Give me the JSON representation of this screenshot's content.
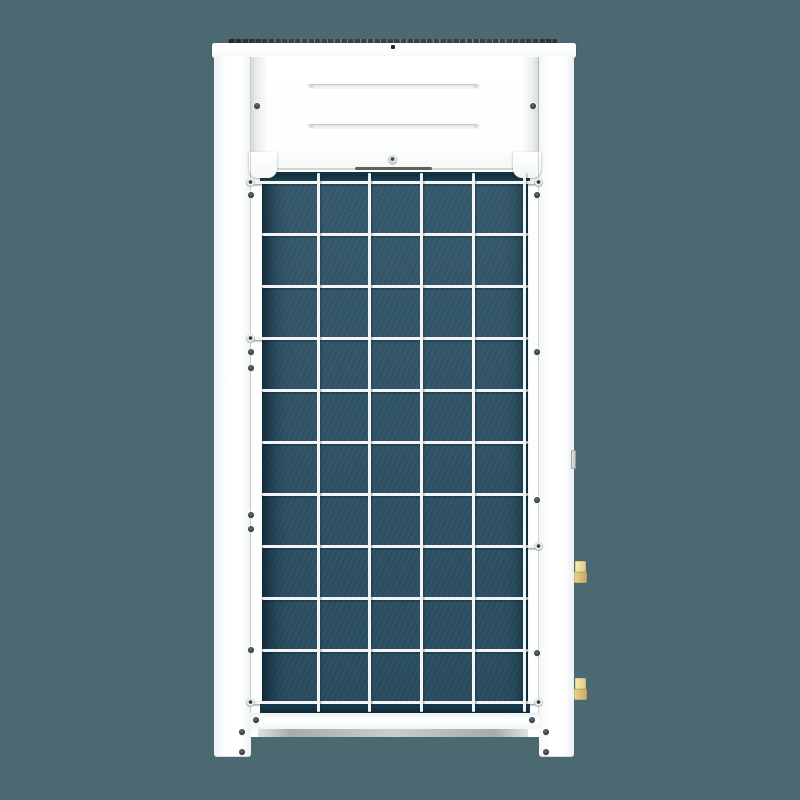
{
  "scene": {
    "subject": "white monoblock heat pump outdoor unit, rear elevation with coil guard grid",
    "background_style": "solid studio backdrop, no text or labels visible"
  },
  "colors": {
    "bg": "#4C6871",
    "cabinet": "#FFFFFF",
    "coil": "#2B5164",
    "coilEdge": "#143A4C",
    "wire": "#F3F5F5",
    "grille": "#3A4143",
    "plinth": "#AEB4B4",
    "brassLight": "#EFE19C",
    "brassDark": "#D8C17C",
    "screw": "#2E3537",
    "serviceTab": "#C7CBCD"
  },
  "parts": {
    "top_grille": "top fan grille (edge-on)",
    "top_cap": "white top cap panel",
    "left_side": "left side panel and leg",
    "right_side": "right side panel and leg",
    "front_panel": "upper access panel with two vent slots",
    "coil": "evaporator coil behind wire guard",
    "wire_grid": "white wire guard grid",
    "base_rail": "bottom rail",
    "plinth": "recessed gray base plinth",
    "fittings": "brass refrigerant pipe connections",
    "service_tab": "gray hinge bracket on right edge"
  },
  "vent_slots": [
    {
      "cx": 393,
      "cy": 86
    },
    {
      "cx": 393,
      "cy": 126
    }
  ],
  "grid": {
    "h_wires": [
      {
        "y": 181,
        "x0": 248,
        "x1": 541,
        "washers": [
          "left",
          "right"
        ]
      },
      {
        "y": 233
      },
      {
        "y": 285
      },
      {
        "y": 337,
        "x0": 248,
        "washers": [
          "left"
        ]
      },
      {
        "y": 389
      },
      {
        "y": 441
      },
      {
        "y": 493
      },
      {
        "y": 545,
        "x1": 541,
        "washers": [
          "right"
        ]
      },
      {
        "y": 597
      },
      {
        "y": 649
      },
      {
        "y": 701,
        "x0": 248,
        "x1": 541,
        "washers": [
          "left",
          "right"
        ]
      }
    ],
    "h_default_x0": 262,
    "h_default_x1": 528,
    "v_wires": {
      "x": [
        317,
        368,
        420,
        472,
        523
      ],
      "y0": 173,
      "y1": 712
    }
  },
  "screws": [
    {
      "x": 393,
      "y": 47,
      "kind": "tiny"
    },
    {
      "x": 257,
      "y": 106
    },
    {
      "x": 533,
      "y": 106
    },
    {
      "x": 392,
      "y": 159,
      "kind": "ring"
    },
    {
      "x": 251,
      "y": 195
    },
    {
      "x": 251,
      "y": 352
    },
    {
      "x": 251,
      "y": 368
    },
    {
      "x": 251,
      "y": 515
    },
    {
      "x": 251,
      "y": 529
    },
    {
      "x": 251,
      "y": 650
    },
    {
      "x": 537,
      "y": 195
    },
    {
      "x": 537,
      "y": 352
    },
    {
      "x": 537,
      "y": 500
    },
    {
      "x": 537,
      "y": 653
    },
    {
      "x": 256,
      "y": 720
    },
    {
      "x": 532,
      "y": 720
    },
    {
      "x": 242,
      "y": 732
    },
    {
      "x": 242,
      "y": 752
    },
    {
      "x": 546,
      "y": 732
    },
    {
      "x": 546,
      "y": 752
    }
  ],
  "fittings": [
    {
      "x": 574,
      "y": 561
    },
    {
      "x": 574,
      "y": 678
    }
  ],
  "service_tab": {
    "x": 571,
    "y": 450,
    "w": 5,
    "h": 19
  }
}
